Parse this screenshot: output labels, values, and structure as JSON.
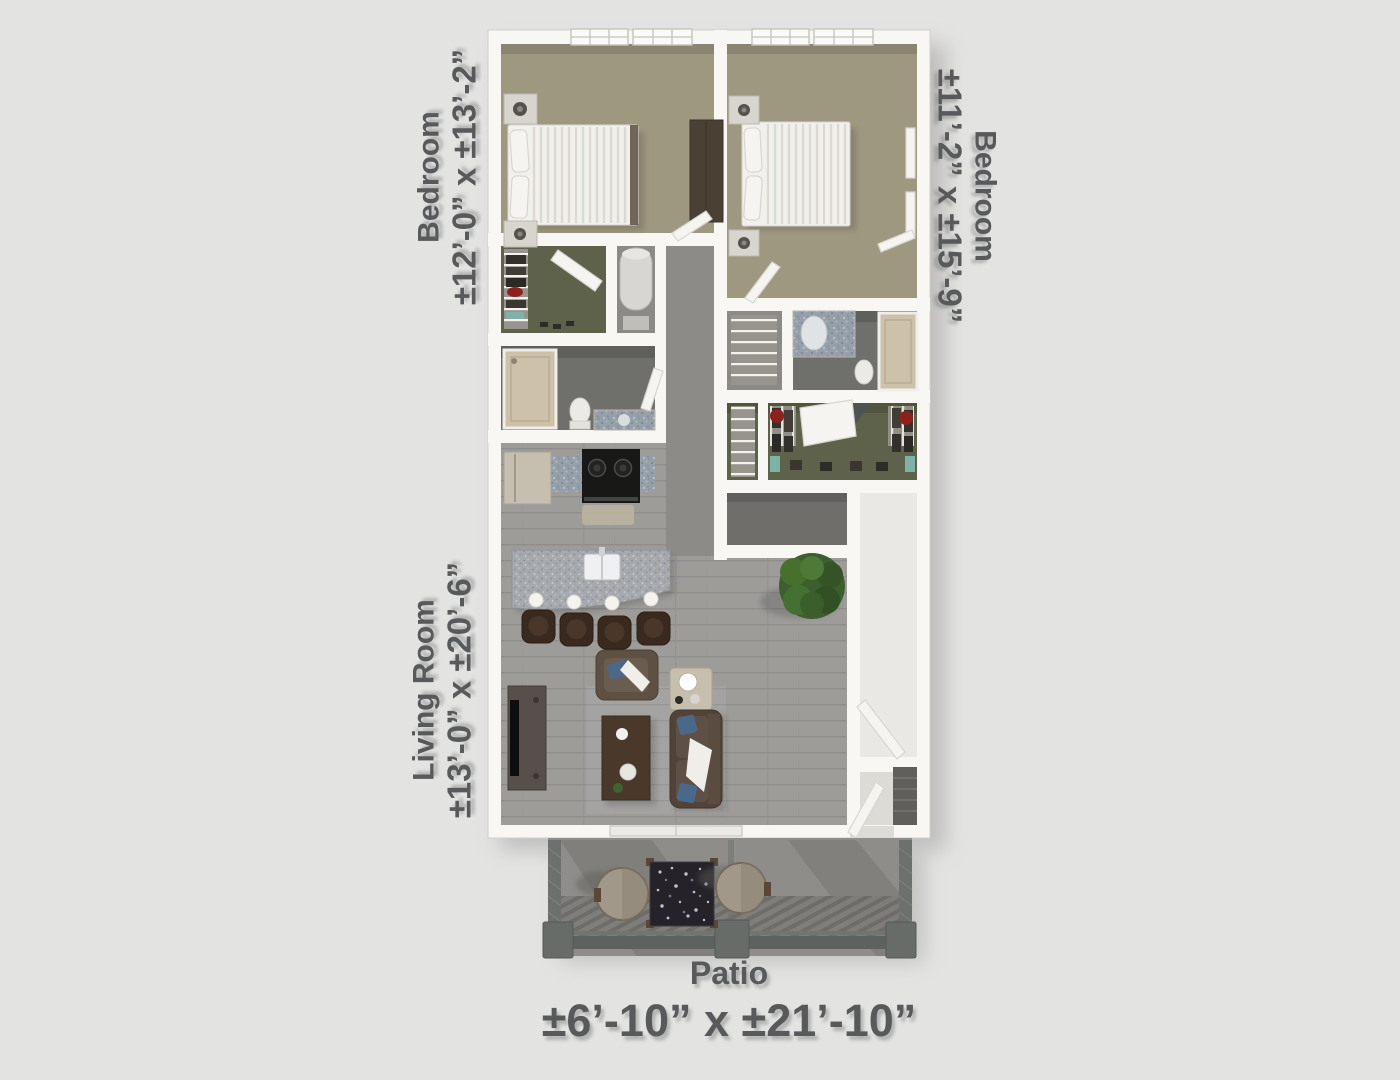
{
  "page": {
    "background_color": "#e3e3e2",
    "type": "3D floor plan rendering"
  },
  "labels": {
    "bedroom_left": {
      "room": "Bedroom",
      "dimensions": "±12’-0” x ±13’-2”"
    },
    "bedroom_right": {
      "room": "Bedroom",
      "dimensions": "±11’-2” x ±15’-9”"
    },
    "living_room": {
      "room": "Living Room",
      "dimensions": "±13’-0” x ±20’-6”"
    },
    "patio": {
      "room": "Patio",
      "dimensions": "±6’-10” x ±21’-10”"
    }
  },
  "colors": {
    "bg": "#e3e3e2",
    "ink": "#58595b",
    "wall": "#f8f7f4",
    "carpet": "#9e9881",
    "hall-carpet": "#8c8b87",
    "living-floor": "#9d9c99",
    "closet-floor": "#5f624a",
    "bath-floor": "#6f6f6c",
    "entry-floor": "#eae8e4",
    "granite": "#96a0aa",
    "island-granite": "#a6a9ad",
    "patio-concrete": "#8e8d89",
    "deck": "#7c7b77",
    "rail": "#5e625e",
    "bed-linen": "#f1f0ec",
    "wood-dark": "#4a392a",
    "sofa-brown": "#51433a",
    "pillow-blue": "#49688a",
    "plant-green": "#3d5f2e",
    "red-accent": "#8d211d",
    "teal-accent": "#7db3a7"
  }
}
